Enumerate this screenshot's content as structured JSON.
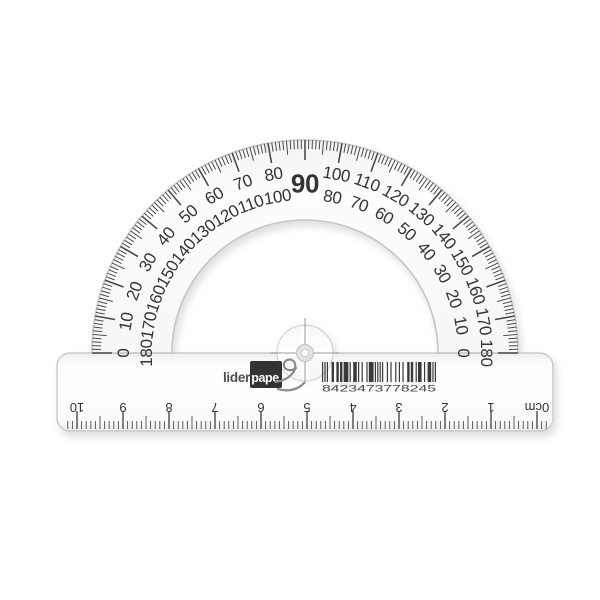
{
  "colors": {
    "background": "#ffffff",
    "plastic_edge": "#c9c9c9",
    "plastic_edge_soft": "#dedede",
    "tick_color": "#4a4a4a",
    "degree_text": "#333333",
    "ruler_text": "#333333",
    "logo_box": "#333333",
    "logo_text_dark": "#4f4f4f",
    "logo_text_light": "#ffffff",
    "swoosh": "#8a8a8a",
    "barcode_bar": "#3a3a3a",
    "barcode_text": "#444444",
    "crosshair_line": "#9a9a9a",
    "crosshair_disc": "#e4e4e4"
  },
  "brand": {
    "prefix": "lider",
    "box_text": "pape",
    "stylized_suffix": "l"
  },
  "barcode": {
    "digits": "8423473778245",
    "modules": "10101000110011011011110100111010010001011110101010100010010001001001000110110010111001001110101"
  },
  "protractor": {
    "apex_label": "90",
    "angles": [
      0,
      10,
      20,
      30,
      40,
      50,
      60,
      70,
      80,
      90,
      100,
      110,
      120,
      130,
      140,
      150,
      160,
      170,
      180
    ],
    "outer_labels": [
      "0",
      "10",
      "20",
      "30",
      "40",
      "50",
      "60",
      "70",
      "80",
      "90",
      "100",
      "110",
      "120",
      "130",
      "140",
      "150",
      "160",
      "170",
      "180"
    ],
    "inner_labels": [
      "180",
      "170",
      "160",
      "150",
      "140",
      "130",
      "120",
      "110",
      "100",
      "90",
      "80",
      "70",
      "60",
      "50",
      "40",
      "30",
      "20",
      "10",
      "0"
    ],
    "tick_step_deg": 1
  },
  "ruler": {
    "unit": "cm",
    "labels": [
      "10",
      "9",
      "8",
      "7",
      "6",
      "5",
      "4",
      "3",
      "2",
      "1",
      "0cm"
    ],
    "mm_count": 100
  }
}
